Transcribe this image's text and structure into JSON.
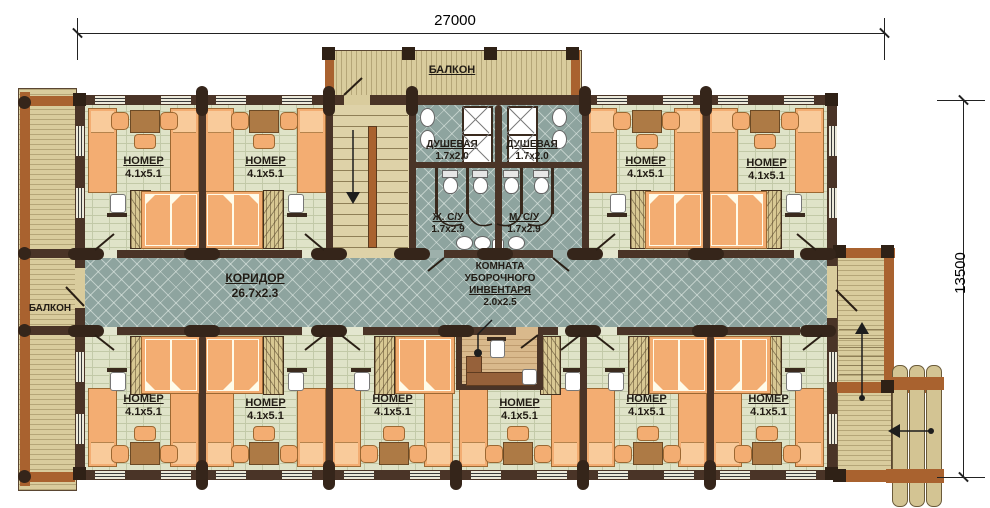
{
  "dimensions": {
    "width_total": "27000",
    "height_total": "13500"
  },
  "areas": {
    "balcony_top": {
      "label": "БАЛКОН"
    },
    "balcony_left": {
      "label": "БАЛКОН"
    },
    "corridor": {
      "label": "КОРИДОР",
      "size": "26.7x2.3"
    },
    "shower_left": {
      "label": "ДУШЕВАЯ",
      "size": "1.7x2.0"
    },
    "shower_right": {
      "label": "ДУШЕВАЯ",
      "size": "1.7x2.0"
    },
    "wc_women": {
      "label": "Ж. С/У",
      "size": "1.7x2.9"
    },
    "wc_men": {
      "label": "М. С/У",
      "size": "1.7x2.9"
    },
    "cleaning_room": {
      "label_lines": [
        "КОМНАТА",
        "УБОРОЧНОГО",
        "ИНВЕНТАРЯ"
      ],
      "size": "2.0x2.5"
    }
  },
  "rooms_top": [
    {
      "label": "НОМЕР",
      "size": "4.1x5.1"
    },
    {
      "label": "НОМЕР",
      "size": "4.1x5.1"
    },
    {
      "label": "НОМЕР",
      "size": "4.1x5.1"
    },
    {
      "label": "НОМЕР",
      "size": "4.1x5.1"
    }
  ],
  "rooms_bottom": [
    {
      "label": "НОМЕР",
      "size": "4.1x5.1"
    },
    {
      "label": "НОМЕР",
      "size": "4.1x5.1"
    },
    {
      "label": "НОМЕР",
      "size": "4.1x5.1"
    },
    {
      "label": "НОМЕР",
      "size": "4.1x5.1"
    },
    {
      "label": "НОМЕР",
      "size": "4.1x5.1"
    },
    {
      "label": "НОМЕР",
      "size": "4.1x5.1"
    }
  ],
  "colors": {
    "wall": "#4a3427",
    "log_end": "#35251a",
    "room_floor": "#dfe3c8",
    "corridor_floor": "#8ea49f",
    "balcony_floor": "#d9cc9d",
    "beam": "#a9622f",
    "furniture": "#f3ad72",
    "desk": "#ad7a45"
  }
}
